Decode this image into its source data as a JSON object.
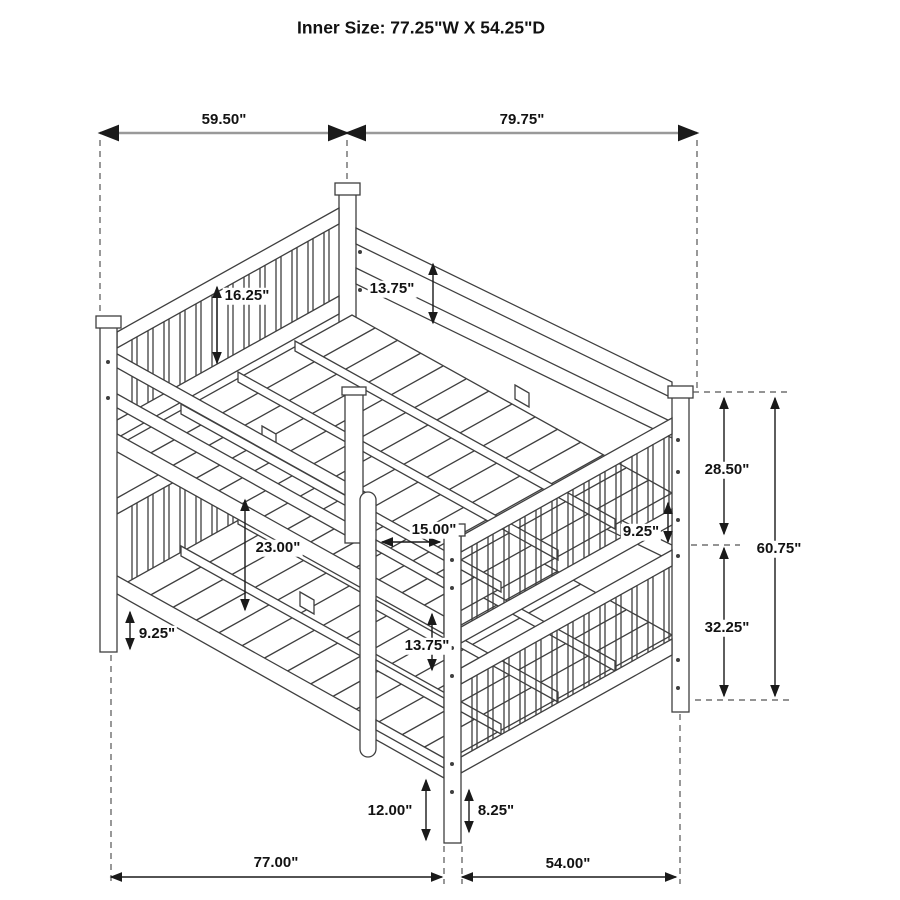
{
  "title": "Inner Size: 77.25\"W X 54.25\"D",
  "unit": "inches",
  "diagram": {
    "subject": "full-over-full bunk bed",
    "style": "isometric technical line drawing with dimension callouts",
    "colors": {
      "background": "#ffffff",
      "line_art": "#3f3f3f",
      "dimension_line": "#222222",
      "top_dimension_line": "#999999",
      "extension_dashed": "#555555",
      "text": "#121212"
    }
  },
  "dimensions": {
    "top_left_width": {
      "label": "59.50\"",
      "value": 59.5,
      "orientation": "horizontal"
    },
    "top_right_length": {
      "label": "79.75\"",
      "value": 79.75,
      "orientation": "horizontal"
    },
    "headboard_panel": {
      "label": "16.25\"",
      "value": 16.25,
      "orientation": "vertical"
    },
    "upper_side_rail": {
      "label": "13.75\"",
      "value": 13.75,
      "orientation": "vertical"
    },
    "upper_section": {
      "label": "28.50\"",
      "value": 28.5,
      "orientation": "vertical"
    },
    "guard_gap_right": {
      "label": "9.25\"",
      "value": 9.25,
      "orientation": "vertical"
    },
    "overall_rail_height": {
      "label": "60.75\"",
      "value": 60.75,
      "orientation": "vertical"
    },
    "lower_section": {
      "label": "32.25\"",
      "value": 32.25,
      "orientation": "vertical"
    },
    "bunk_clearance": {
      "label": "23.00\"",
      "value": 23.0,
      "orientation": "vertical"
    },
    "ladder_width": {
      "label": "15.00\"",
      "value": 15.0,
      "orientation": "horizontal"
    },
    "ladder_gap": {
      "label": "13.75\"",
      "value": 13.75,
      "orientation": "vertical"
    },
    "lower_clearance_left": {
      "label": "9.25\"",
      "value": 9.25,
      "orientation": "vertical"
    },
    "front_leg_clearance": {
      "label": "12.00\"",
      "value": 12.0,
      "orientation": "vertical"
    },
    "right_leg_clearance": {
      "label": "8.25\"",
      "value": 8.25,
      "orientation": "vertical"
    },
    "bottom_length": {
      "label": "77.00\"",
      "value": 77.0,
      "orientation": "horizontal"
    },
    "bottom_depth": {
      "label": "54.00\"",
      "value": 54.0,
      "orientation": "horizontal"
    }
  }
}
